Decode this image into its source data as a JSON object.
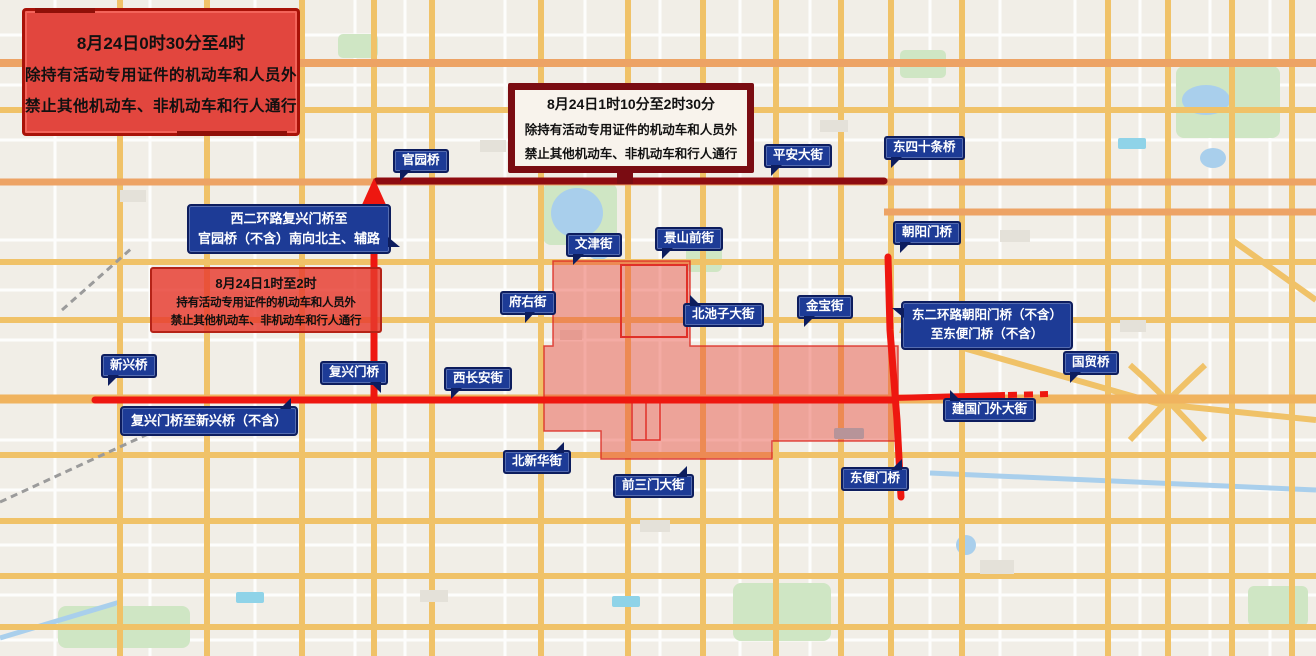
{
  "notices": {
    "early": {
      "lines": [
        "8月24日0时30分至4时",
        "除持有活动专用证件的机动车和人员外",
        "禁止其他机动车、非机动车和行人通行"
      ]
    },
    "mid": {
      "lines": [
        "8月24日1时10分至2时30分",
        "除持有活动专用证件的机动车和人员外",
        "禁止其他机动车、非机动车和行人通行"
      ]
    },
    "inner": {
      "lines": [
        "8月24日1时至2时",
        "持有活动专用证件的机动车和人员外",
        "禁止其他机动车、非机动车和行人通行"
      ]
    }
  },
  "route_notes": {
    "west_second_ring": {
      "lines": [
        "西二环路复兴门桥至",
        "官园桥（不含）南向北主、辅路"
      ]
    },
    "east_second_ring": {
      "lines": [
        "东二环路朝阳门桥（不含）",
        "至东便门桥（不含）"
      ]
    },
    "fuxingmen_xinxing": {
      "lines": [
        "复兴门桥至新兴桥（不含）"
      ]
    }
  },
  "street_labels": {
    "guanyuanqiao": "官园桥",
    "pingan_dajie": "平安大街",
    "dongsishitiao_qiao": "东四十条桥",
    "chaoyangmen_qiao": "朝阳门桥",
    "wenjin_jie": "文津街",
    "jingshan_qianjie": "景山前街",
    "fuyou_jie": "府右街",
    "beichizi_dajie": "北池子大街",
    "jinbao_jie": "金宝街",
    "xinxing_qiao": "新兴桥",
    "fuxingmen_qiao": "复兴门桥",
    "xichangan_jie": "西长安街",
    "guomao_qiao": "国贸桥",
    "jianguomenwai_dajie": "建国门外大街",
    "beixinhua_jie": "北新华街",
    "qiansanmen_dajie": "前三门大街",
    "dongbianmen_qiao": "东便门桥"
  },
  "colors": {
    "restriction_line_red": "#ee1710",
    "restriction_line_darkred": "#8e0b10",
    "restricted_zone_fill": "rgba(232,70,58,0.45)",
    "label_navy": "#1d3b96",
    "notice_red": "#e2463e",
    "notice_darkred_border": "#7a0c12"
  }
}
